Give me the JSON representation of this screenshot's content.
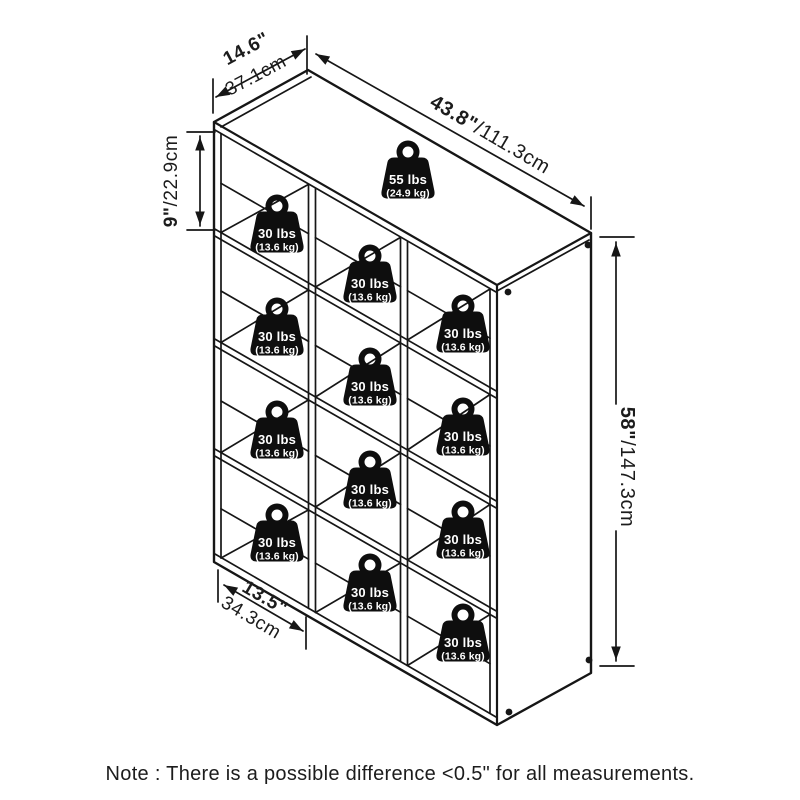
{
  "diagram": {
    "dimensions": {
      "depth_in": "14.6\"",
      "depth_cm": "37.1cm",
      "width_in": "43.8\"",
      "width_cm": "/111.3cm",
      "cube_height_in": "9\"",
      "cube_height_cm": "/22.9cm",
      "height_in": "58\"",
      "height_cm": "/147.3cm",
      "cube_width_in": "13.5\"",
      "cube_width_cm": "34.3cm"
    },
    "weights": {
      "top_shelf": {
        "lbs": "55 lbs",
        "kg": "(24.9 kg)"
      },
      "cube": {
        "lbs": "30 lbs",
        "kg": "(13.6 kg)"
      },
      "cube_count": 12
    },
    "grid": {
      "rows": 4,
      "columns": 3
    }
  },
  "note": "Note : There is a possible difference <0.5\" for all measurements.",
  "colors": {
    "line": "#161616",
    "icon": "#0e0e0e",
    "text": "#1c1c1c",
    "background": "#ffffff"
  }
}
